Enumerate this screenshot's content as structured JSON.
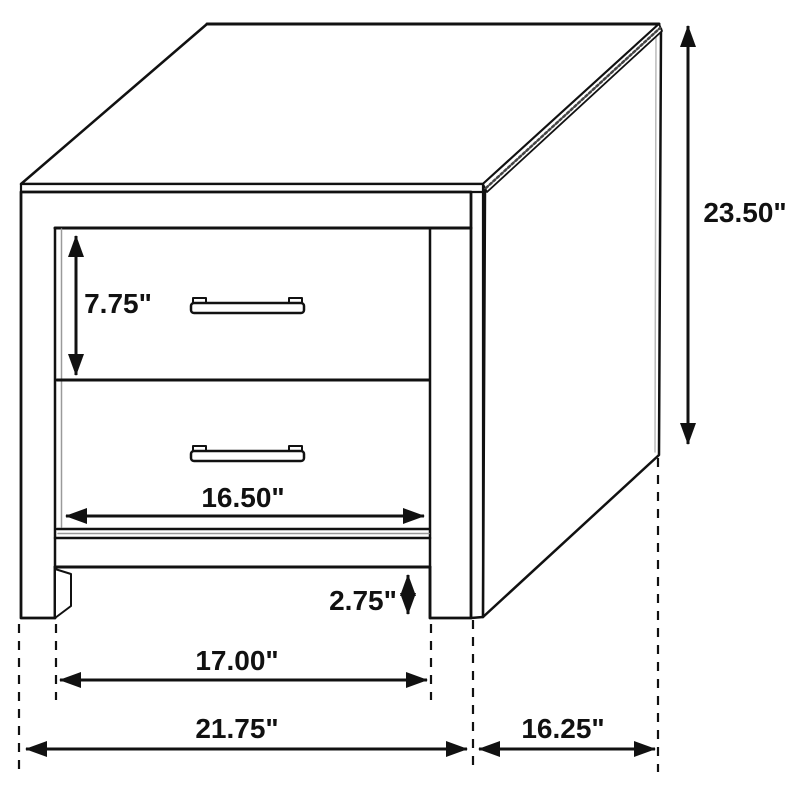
{
  "page": {
    "background": "#ffffff",
    "line_color": "#111111"
  },
  "diagram": {
    "title": "Two-drawer nightstand dimension diagram",
    "view": "isometric line drawing",
    "unit": "inches",
    "labels": {
      "overall_height": "23.50\"",
      "top_drawer_height": "7.75\"",
      "drawer_opening_width": "16.50\"",
      "leg_height": "2.75\"",
      "between_legs_width": "17.00\"",
      "overall_width": "21.75\"",
      "side_depth": "16.25\""
    }
  }
}
